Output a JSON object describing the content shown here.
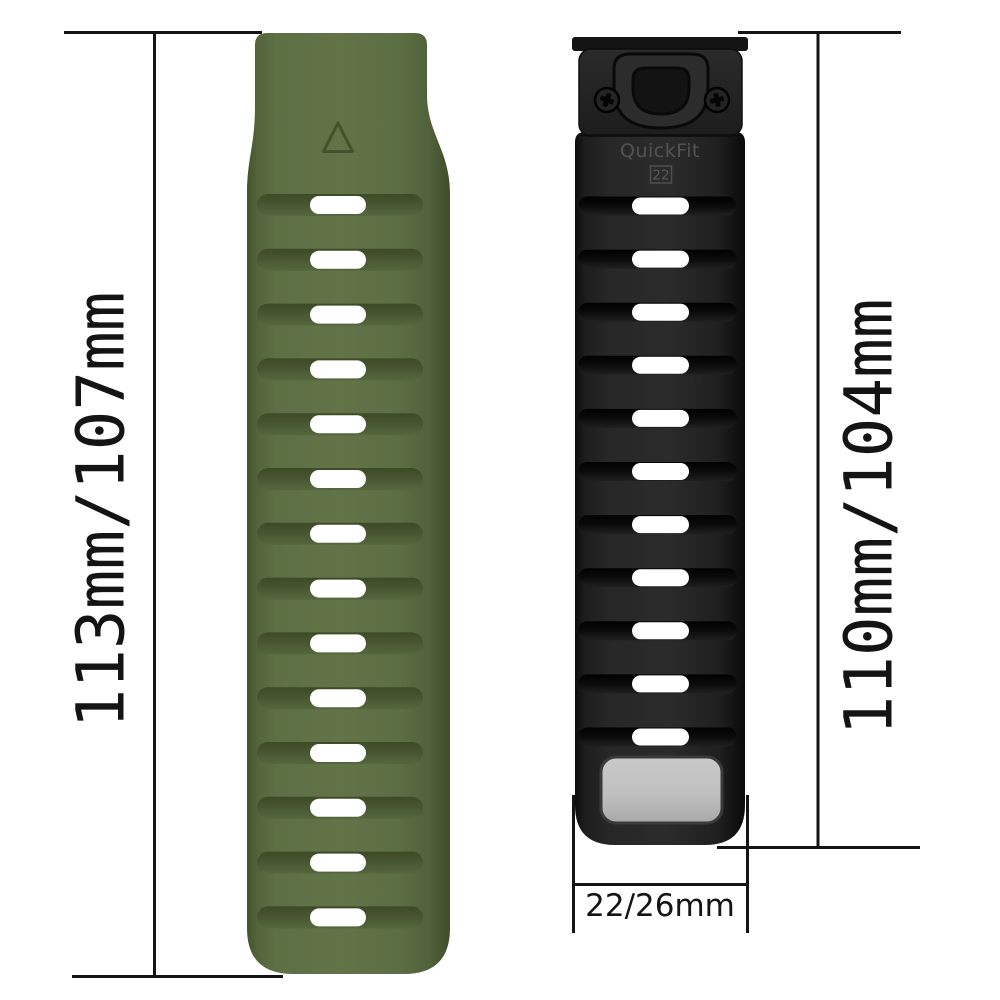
{
  "diagram": {
    "background": "#ffffff",
    "annotation_color": "#141414"
  },
  "dimensions": {
    "left_band_length_label": "113mm/107mm",
    "right_band_length_label": "110mm/104mm",
    "band_width_label": "22/26mm"
  },
  "green_band": {
    "color": "#5d6f44",
    "hole_color": "#ffffff",
    "hole_count": 14,
    "first_hole_y": 205,
    "hole_spacing": 54.8
  },
  "black_band": {
    "color": "#232323",
    "connector_brand": "QuickFit",
    "connector_size": "22",
    "hole_color": "#ffffff",
    "hole_count": 11,
    "first_hole_y": 206,
    "hole_spacing": 53.1,
    "plate_color": "#bdbdbd"
  }
}
